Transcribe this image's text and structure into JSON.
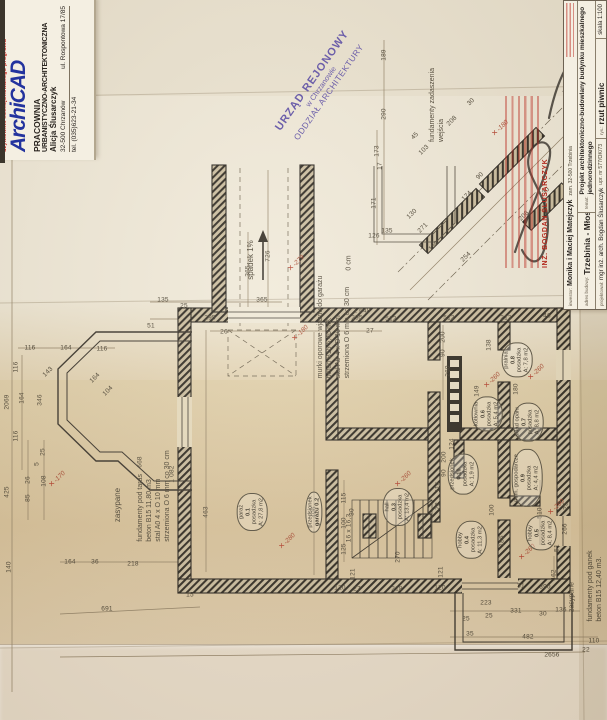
{
  "letterhead": {
    "logo": "ArchiCAD",
    "logo_sub": "użytkownik licencjonowanego programu",
    "line1": "PRACOWNIA",
    "line2": "URBANISTYCZNO-ARCHITEKTONICZNA",
    "line3": "Alicja Ślusarczyk",
    "city": "32-500 Chrzanów",
    "street": "ul. Rospontowa 17/85",
    "tel": "tel. (035)623-21-34"
  },
  "stamp_urzad": {
    "line1": "URZĄD REJONOWY",
    "line2": "w Chrzanowie",
    "line3": "ODDZIAŁ ARCHITEKTURY"
  },
  "stamp_red": {
    "name": "INŻ. BOGDAN ŚLUSARCZYK"
  },
  "title_block": {
    "investor_label": "inwestor:",
    "investor": "Monika i Maciej Matejczyk",
    "investor_addr": "zam. 32-500 Trzebinia",
    "address_label": "adres budowy:",
    "address": "Trzebinia - Młoszowa",
    "subject_label": "temat:",
    "subject": "Projekt architektoniczno-budowlany budynku mieszkalnego jednorodzinnego",
    "designer_label": "projektował:",
    "designer": "mgr inż. arch. Bogdan Ślusarczyk",
    "designer_lic": "upr. nr 577/OK/73",
    "drawing_label": "rys.:",
    "drawing": "rzut piwnic",
    "scale": "skala 1:100"
  },
  "colors": {
    "paper": "#efe8d6",
    "paper_tan": "#d8c29a",
    "ink": "#332d24",
    "dim_ink": "#4c4434",
    "stamp_purple": "#5f51a6",
    "stamp_red": "#b3291e",
    "logo_blue": "#23339e",
    "level_red": "#a84a32"
  },
  "plan": {
    "notes": [
      {
        "lines": [
          "spadek 1%"
        ],
        "x": 251,
        "y": 260,
        "fs": 8
      },
      {
        "lines": [
          "murki oporowe wjazdu do garażu",
          "beton B15  5,40 m3.",
          "stal A0 4 x O 10 mm",
          "strzemiona O 6 mm co 30 cm"
        ],
        "x": 334,
        "y": 327,
        "fs": 7
      },
      {
        "lines": [
          "fundamenty zadaszenia",
          "wejścia"
        ],
        "x": 437,
        "y": 105,
        "fs": 7
      },
      {
        "lines": [
          "zasypane"
        ],
        "x": 118,
        "y": 505,
        "fs": 8
      },
      {
        "lines": [
          "fundamenty pod taras",
          "beton B15  11,80 m3.",
          "stal A0 4 x O 10 mm",
          "strzemiona O 6 mm co 30 cm"
        ],
        "x": 154,
        "y": 496,
        "fs": 7
      },
      {
        "lines": [
          "zasypane"
        ],
        "x": 572,
        "y": 597,
        "fs": 7
      },
      {
        "lines": [
          "fundamenty pod ganek",
          "beton B15  12,40 m3."
        ],
        "x": 595,
        "y": 586,
        "fs": 7
      },
      {
        "lines": [
          "0 cm"
        ],
        "x": 349,
        "y": 263,
        "fs": 7
      }
    ],
    "rooms": [
      {
        "lines": [
          "garaż",
          "0.1",
          "posadzka",
          "A: 27,8 m2"
        ],
        "x": 252,
        "y": 512
      },
      {
        "lines": [
          "przedsionek",
          "garażu 0.2"
        ],
        "x": 314,
        "y": 512
      },
      {
        "lines": [
          "hall",
          "0.3",
          "posadzka",
          "A: 13,4 m2"
        ],
        "x": 398,
        "y": 507
      },
      {
        "lines": [
          "hobby",
          "0.4",
          "posadzka",
          "A: 11,3 m2"
        ],
        "x": 471,
        "y": 540
      },
      {
        "lines": [
          "hobby",
          "0.5",
          "posadzka",
          "A: 8,4 m2"
        ],
        "x": 541,
        "y": 533
      },
      {
        "lines": [
          "kotłownia",
          "0.6",
          "posadzka",
          "A: 5,4 m2"
        ],
        "x": 487,
        "y": 414
      },
      {
        "lines": [
          "skład opału",
          "0.7",
          "posadzka",
          "A: 8,8 m2"
        ],
        "x": 528,
        "y": 422
      },
      {
        "lines": [
          "pralnia",
          "0.8",
          "posadzka",
          "A: 7,8 m2"
        ],
        "x": 517,
        "y": 360
      },
      {
        "lines": [
          "pom. gospodarcze",
          "0.9",
          "posadzka",
          "A: 4,4 m2"
        ],
        "x": 527,
        "y": 478
      },
      {
        "lines": [
          "przedsionek",
          "0.10",
          "posadzka",
          "A: 1,9 m2"
        ],
        "x": 463,
        "y": 474
      }
    ],
    "levels": [
      {
        "t": "-279",
        "x": 296,
        "y": 263
      },
      {
        "t": "-180",
        "x": 300,
        "y": 333
      },
      {
        "t": "-280",
        "x": 287,
        "y": 541
      },
      {
        "t": "-260",
        "x": 492,
        "y": 380
      },
      {
        "t": "-260",
        "x": 536,
        "y": 372
      },
      {
        "t": "-260",
        "x": 403,
        "y": 479
      },
      {
        "t": "-260",
        "x": 556,
        "y": 507
      },
      {
        "t": "-260",
        "x": 527,
        "y": 552
      },
      {
        "t": "-170",
        "x": 57,
        "y": 479
      },
      {
        "t": "-180",
        "x": 500,
        "y": 128
      }
    ],
    "dims": [
      {
        "t": "135",
        "x": 163,
        "y": 300,
        "r": 0
      },
      {
        "t": "25",
        "x": 184,
        "y": 306,
        "r": 0
      },
      {
        "t": "365",
        "x": 262,
        "y": 300,
        "r": 0
      },
      {
        "t": "295",
        "x": 210,
        "y": 318,
        "r": 0
      },
      {
        "t": "295",
        "x": 357,
        "y": 318,
        "r": 0
      },
      {
        "t": "51",
        "x": 151,
        "y": 326,
        "r": 0
      },
      {
        "t": "26",
        "x": 224,
        "y": 332,
        "r": 0
      },
      {
        "t": "27",
        "x": 370,
        "y": 331,
        "r": 0
      },
      {
        "t": "1 648",
        "x": 362,
        "y": 311,
        "r": 0
      },
      {
        "t": "512",
        "x": 391,
        "y": 319,
        "r": 0
      },
      {
        "t": "513",
        "x": 449,
        "y": 318,
        "r": 0
      },
      {
        "t": "213",
        "x": 506,
        "y": 318,
        "r": 0
      },
      {
        "t": "46",
        "x": 547,
        "y": 316,
        "r": 0
      },
      {
        "t": "726",
        "x": 268,
        "y": 256,
        "r": -90
      },
      {
        "t": "365",
        "x": 248,
        "y": 271,
        "r": -90
      },
      {
        "t": "116",
        "x": 30,
        "y": 348,
        "r": 0
      },
      {
        "t": "164",
        "x": 66,
        "y": 348,
        "r": 0
      },
      {
        "t": "116",
        "x": 102,
        "y": 349,
        "r": 0
      },
      {
        "t": "2069",
        "x": 7,
        "y": 402,
        "r": -90
      },
      {
        "t": "116",
        "x": 16,
        "y": 367,
        "r": -90
      },
      {
        "t": "164",
        "x": 22,
        "y": 398,
        "r": -90
      },
      {
        "t": "346",
        "x": 40,
        "y": 400,
        "r": -90
      },
      {
        "t": "143",
        "x": 48,
        "y": 372,
        "r": -45
      },
      {
        "t": "164",
        "x": 95,
        "y": 378,
        "r": -45
      },
      {
        "t": "104",
        "x": 108,
        "y": 391,
        "r": -45
      },
      {
        "t": "116",
        "x": 16,
        "y": 436,
        "r": -90
      },
      {
        "t": "425",
        "x": 7,
        "y": 492,
        "r": -90
      },
      {
        "t": "25",
        "x": 43,
        "y": 452,
        "r": -90
      },
      {
        "t": "5",
        "x": 37,
        "y": 464,
        "r": -90
      },
      {
        "t": "108",
        "x": 44,
        "y": 481,
        "r": -90
      },
      {
        "t": "26",
        "x": 28,
        "y": 480,
        "r": -90
      },
      {
        "t": "85",
        "x": 28,
        "y": 498,
        "r": -90
      },
      {
        "t": "140",
        "x": 9,
        "y": 567,
        "r": -90
      },
      {
        "t": "189",
        "x": 384,
        "y": 55,
        "r": -90
      },
      {
        "t": "290",
        "x": 384,
        "y": 114,
        "r": -90
      },
      {
        "t": "173",
        "x": 377,
        "y": 151,
        "r": -90
      },
      {
        "t": "17",
        "x": 380,
        "y": 166,
        "r": -90
      },
      {
        "t": "171",
        "x": 374,
        "y": 203,
        "r": -90
      },
      {
        "t": "135",
        "x": 387,
        "y": 231,
        "r": 0
      },
      {
        "t": "126",
        "x": 374,
        "y": 236,
        "r": 0
      },
      {
        "t": "103",
        "x": 424,
        "y": 150,
        "r": -45
      },
      {
        "t": "45",
        "x": 415,
        "y": 136,
        "r": -45
      },
      {
        "t": "208",
        "x": 452,
        "y": 121,
        "r": -45
      },
      {
        "t": "30",
        "x": 471,
        "y": 102,
        "r": -45
      },
      {
        "t": "90",
        "x": 480,
        "y": 176,
        "r": -45
      },
      {
        "t": "174",
        "x": 467,
        "y": 196,
        "r": -45
      },
      {
        "t": "254",
        "x": 466,
        "y": 257,
        "r": -45
      },
      {
        "t": "208",
        "x": 524,
        "y": 216,
        "r": -45
      },
      {
        "t": "30",
        "x": 546,
        "y": 191,
        "r": -45
      },
      {
        "t": "130",
        "x": 412,
        "y": 214,
        "r": -45
      },
      {
        "t": "271",
        "x": 423,
        "y": 228,
        "r": -45
      },
      {
        "t": "150",
        "x": 434,
        "y": 246,
        "r": -45
      },
      {
        "t": "198",
        "x": 586,
        "y": 178,
        "r": -90
      },
      {
        "t": "135",
        "x": 586,
        "y": 228,
        "r": -90
      },
      {
        "t": "141",
        "x": 586,
        "y": 258,
        "r": -90
      },
      {
        "t": "463",
        "x": 206,
        "y": 512,
        "r": -90
      },
      {
        "t": "406",
        "x": 314,
        "y": 512,
        "r": -90
      },
      {
        "t": "16 x 16,3",
        "x": 349,
        "y": 528,
        "r": -90
      },
      {
        "t": "115",
        "x": 344,
        "y": 498,
        "r": -90
      },
      {
        "t": "30",
        "x": 352,
        "y": 512,
        "r": -90
      },
      {
        "t": "100",
        "x": 344,
        "y": 523,
        "r": -90
      },
      {
        "t": "125",
        "x": 344,
        "y": 549,
        "r": -90
      },
      {
        "t": "270",
        "x": 398,
        "y": 557,
        "r": -90
      },
      {
        "t": "121",
        "x": 353,
        "y": 574,
        "r": -90
      },
      {
        "t": "121",
        "x": 441,
        "y": 572,
        "r": -90
      },
      {
        "t": "114",
        "x": 438,
        "y": 487,
        "r": -90
      },
      {
        "t": "72",
        "x": 438,
        "y": 506,
        "r": -90
      },
      {
        "t": "200",
        "x": 443,
        "y": 337,
        "r": -90
      },
      {
        "t": "90",
        "x": 443,
        "y": 353,
        "r": -90
      },
      {
        "t": "260",
        "x": 448,
        "y": 371,
        "r": -90
      },
      {
        "t": "138",
        "x": 489,
        "y": 345,
        "r": -90
      },
      {
        "t": "180",
        "x": 516,
        "y": 389,
        "r": -90
      },
      {
        "t": "149",
        "x": 477,
        "y": 391,
        "r": -90
      },
      {
        "t": "200",
        "x": 444,
        "y": 457,
        "r": -90
      },
      {
        "t": "90",
        "x": 444,
        "y": 473,
        "r": -90
      },
      {
        "t": "124",
        "x": 452,
        "y": 444,
        "r": -90
      },
      {
        "t": "100",
        "x": 492,
        "y": 510,
        "r": -90
      },
      {
        "t": "186",
        "x": 502,
        "y": 541,
        "r": -90
      },
      {
        "t": "510",
        "x": 540,
        "y": 513,
        "r": -90
      },
      {
        "t": "266",
        "x": 565,
        "y": 529,
        "r": -90
      },
      {
        "t": "25",
        "x": 566,
        "y": 506,
        "r": -90
      },
      {
        "t": "51",
        "x": 557,
        "y": 548,
        "r": -90
      },
      {
        "t": "462",
        "x": 554,
        "y": 575,
        "r": -90
      },
      {
        "t": "120",
        "x": 340,
        "y": 588,
        "r": 0
      },
      {
        "t": "27",
        "x": 357,
        "y": 589,
        "r": 0
      },
      {
        "t": "218",
        "x": 397,
        "y": 589,
        "r": 0
      },
      {
        "t": "120",
        "x": 440,
        "y": 588,
        "r": 0
      },
      {
        "t": "164",
        "x": 70,
        "y": 562,
        "r": 0
      },
      {
        "t": "36",
        "x": 95,
        "y": 562,
        "r": 0
      },
      {
        "t": "218",
        "x": 133,
        "y": 564,
        "r": 0
      },
      {
        "t": "15",
        "x": 190,
        "y": 595,
        "r": 0
      },
      {
        "t": "691",
        "x": 107,
        "y": 609,
        "r": 0
      },
      {
        "t": "331",
        "x": 516,
        "y": 611,
        "r": 0
      },
      {
        "t": "30",
        "x": 543,
        "y": 614,
        "r": 0
      },
      {
        "t": "136",
        "x": 561,
        "y": 610,
        "r": 0
      },
      {
        "t": "25",
        "x": 489,
        "y": 616,
        "r": 0
      },
      {
        "t": "25",
        "x": 466,
        "y": 619,
        "r": 0
      },
      {
        "t": "35",
        "x": 470,
        "y": 634,
        "r": 0
      },
      {
        "t": "482",
        "x": 528,
        "y": 637,
        "r": 0
      },
      {
        "t": "110",
        "x": 594,
        "y": 641,
        "r": 0
      },
      {
        "t": "22",
        "x": 586,
        "y": 650,
        "r": 0
      },
      {
        "t": "390",
        "x": 545,
        "y": 587,
        "r": 0
      },
      {
        "t": "31",
        "x": 521,
        "y": 586,
        "r": 0
      },
      {
        "t": "223",
        "x": 486,
        "y": 603,
        "r": 0
      },
      {
        "t": "2656",
        "x": 552,
        "y": 655,
        "r": 0
      },
      {
        "t": "668",
        "x": 140,
        "y": 462,
        "r": -90
      },
      {
        "t": "1 082",
        "x": 172,
        "y": 474,
        "r": -90
      }
    ]
  }
}
